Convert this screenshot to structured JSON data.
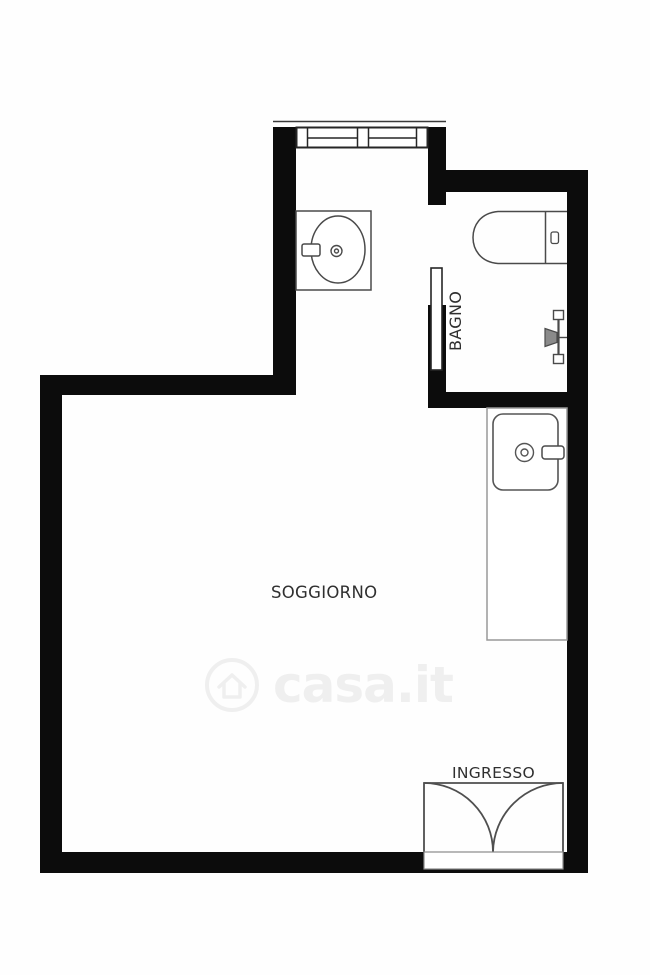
{
  "plan": {
    "type": "apartment-floor-plan",
    "labels": {
      "soggiorno": "SOGGIORNO",
      "bagno": "BAGNO",
      "ingresso": "INGRESSO"
    },
    "fixtures": {
      "window": "double-casement-window",
      "washbasin": "washbasin-with-counter",
      "toilet": "toilet-with-cistern",
      "shower": "shower-rail-with-head",
      "kitchen_counter": "kitchen-counter",
      "kitchen_sink": "kitchen-sink-with-faucet",
      "bathroom_door": "open-door-leaf",
      "entrance_door": "double-swing-door"
    },
    "colors": {
      "background": "#ffffff",
      "wall": "#0c0c0c",
      "fixture_stroke": "#4a4a4a",
      "label_text": "#2f2f2f",
      "watermark": "#efefef"
    }
  },
  "watermark": {
    "text": "casa.it",
    "logo": "casa-house-logo"
  }
}
